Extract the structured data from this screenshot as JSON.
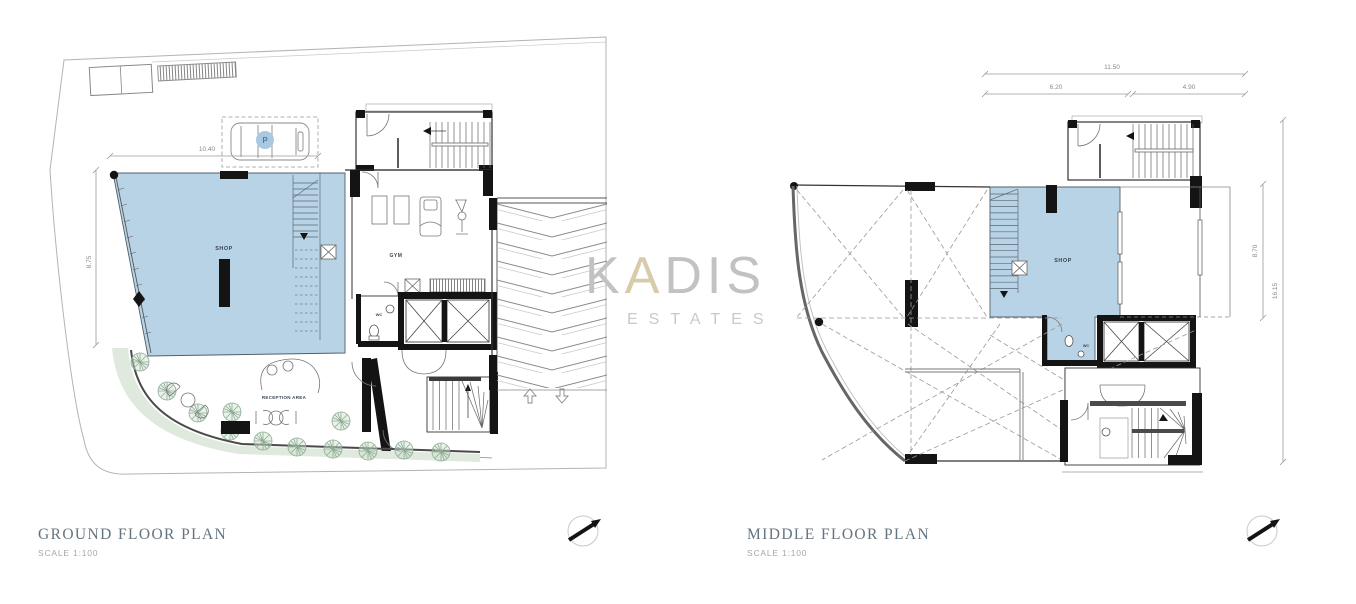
{
  "watermark": {
    "k": "K",
    "a": "A",
    "dis": "DIS",
    "estates": "ESTATES"
  },
  "colors": {
    "room_fill": "#b9d3e6",
    "landscape_fill": "#dfe9dd",
    "tree_stroke": "#8fac92",
    "wall": "#141414",
    "title_text": "#64747f",
    "dim_text": "#8a8a8a",
    "watermark_gray": "#c2c2c2",
    "watermark_beige": "#d8cbaa",
    "parking_circle": "#a9c9e2"
  },
  "ground_floor": {
    "title": "GROUND FLOOR PLAN",
    "scale": "SCALE  1:100",
    "labels": {
      "shop": "SHOP",
      "gym": "GYM",
      "wc": "WC",
      "reception": "RECEPTION AREA",
      "parking": "P"
    },
    "dimensions": {
      "width": "10.40",
      "height": "8.75"
    }
  },
  "middle_floor": {
    "title": "MIDDLE FLOOR PLAN",
    "scale": "SCALE  1:100",
    "labels": {
      "shop": "SHOP",
      "wc": "WC"
    },
    "dimensions": {
      "total_width": "11.50",
      "left_width": "6.20",
      "right_width": "4.90",
      "terrace_height": "8.70",
      "total_height": "16.15"
    }
  }
}
